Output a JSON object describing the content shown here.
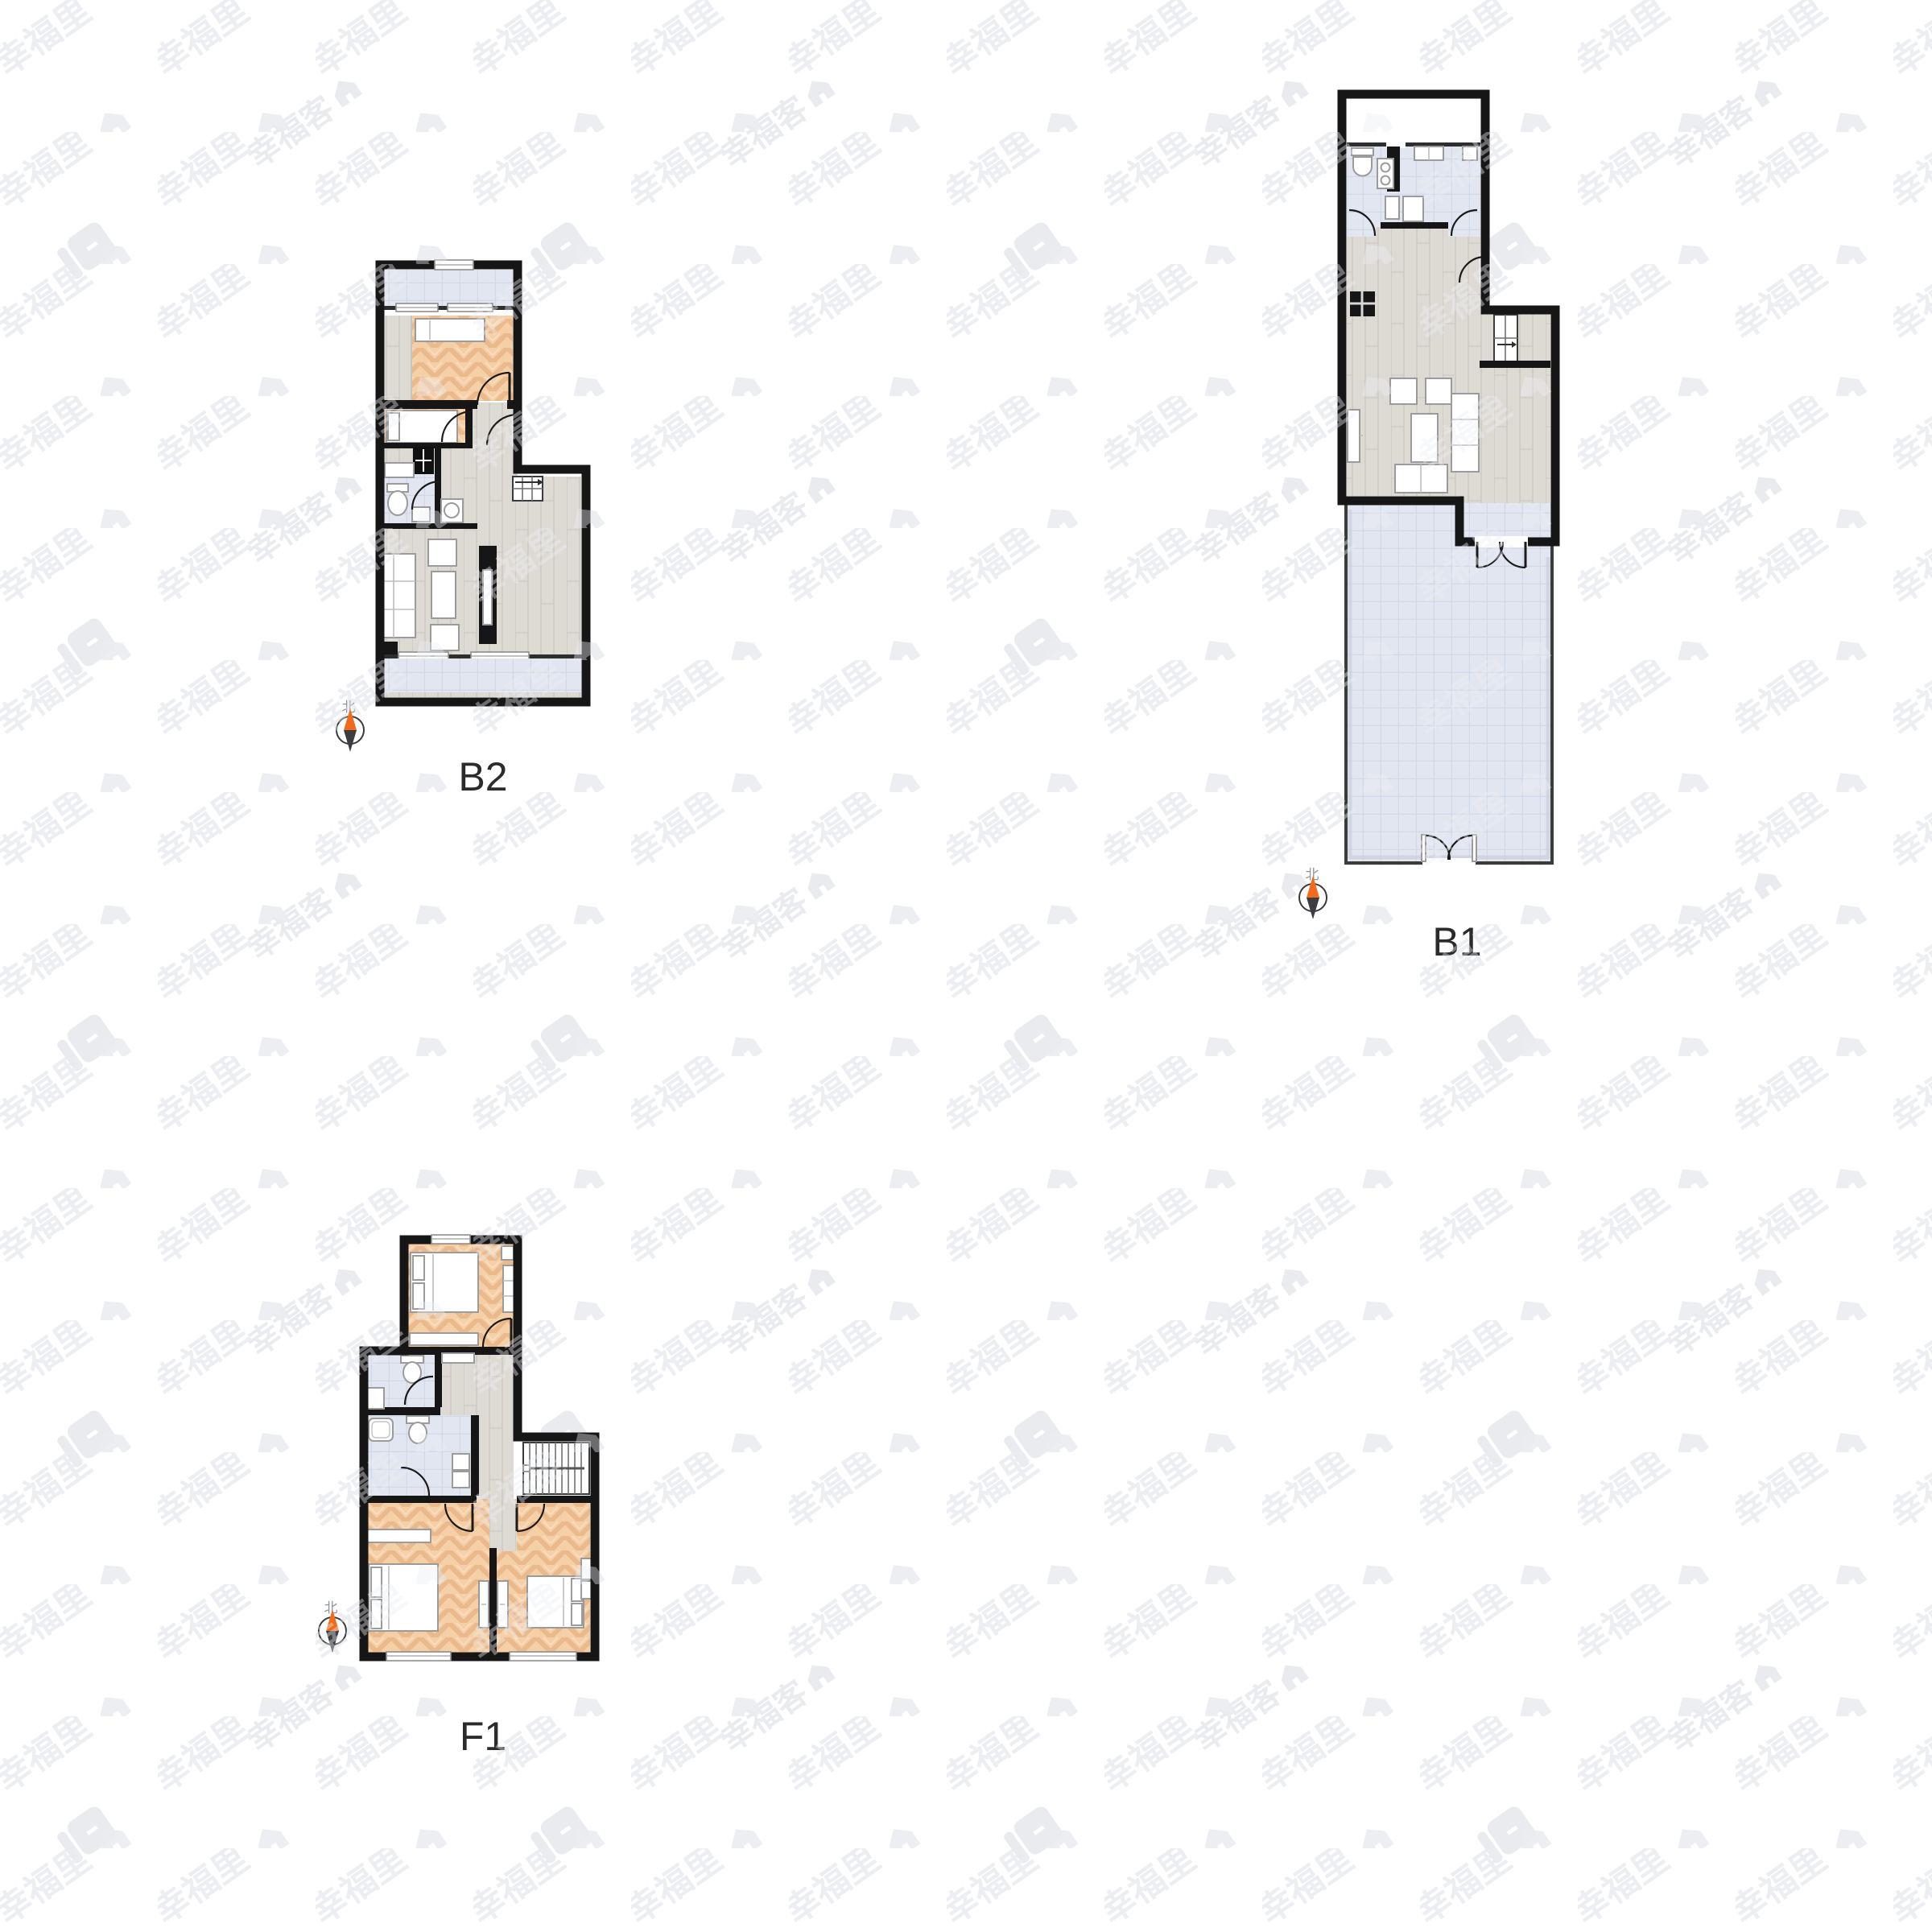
{
  "watermark": {
    "brand_text": "幸福里",
    "secondary_text": "幸福客",
    "color": "#eceef2",
    "logo_color": "#e9ebef"
  },
  "plans": [
    {
      "id": "B2",
      "label": "B2",
      "compass_label": "北"
    },
    {
      "id": "B1",
      "label": "B1",
      "compass_label": "北"
    },
    {
      "id": "F1",
      "label": "F1",
      "compass_label": "北"
    }
  ],
  "colors": {
    "wall": "#161616",
    "tile_floor": "#e2e6f0",
    "wood_floor": "#dddad4",
    "parquet_floor": "#f5cfa5",
    "label_color": "#2b2b2b",
    "compass_north": "#f26b1d",
    "compass_south": "#3c3c42",
    "watermark": "#eceef2"
  }
}
